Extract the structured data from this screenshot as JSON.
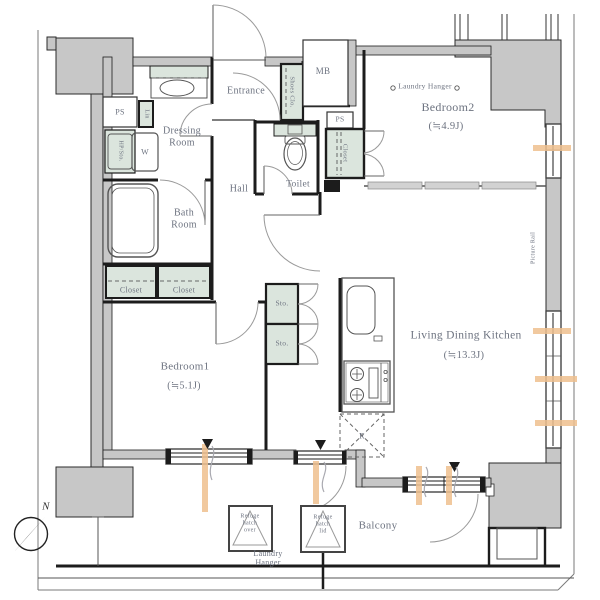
{
  "title": "apartment-floor-plan",
  "colors": {
    "wall": "#c7c7c7",
    "green": "#dbe5dd",
    "orange": "#eebf8e",
    "label": "#6d7380",
    "line": "#1c1c1c"
  },
  "labels": {
    "ps_left": "PS",
    "lin": "Lin",
    "utility": "HP/Sto.",
    "washer": "W",
    "dressing": {
      "l1": "Dressing",
      "l2": "Room"
    },
    "bath": {
      "l1": "Bath",
      "l2": "Room"
    },
    "closet_a": "Closet",
    "closet_b": "Closet",
    "bedroom1": {
      "name": "Bedroom1",
      "size": "(≒5.1J)"
    },
    "entrance": "Entrance",
    "shoes_closet": "Shoes Clo.",
    "mb": "MB",
    "ps_right": "PS",
    "toilet": "Toilet",
    "hall": "Hall",
    "closet_bedroom2": "Closet",
    "laundry_hanger_bedroom2": "Laundry Hanger",
    "bedroom2": {
      "name": "Bedroom2",
      "size": "(≒4.9J)"
    },
    "picture_rail": "Picture Rail",
    "sto_1": "Sto.",
    "sto_2": "Sto.",
    "ldk": {
      "name": "Living Dining Kitchen",
      "size": "(≒13.3J)"
    },
    "fridge": "R",
    "balcony": "Balcony",
    "laundry_hanger_balcony": {
      "l1": "Laundry",
      "l2": "Hanger"
    },
    "refuge_hatch_left": {
      "l1": "Refuge",
      "l2": "hatch",
      "l3": "over"
    },
    "refuge_hatch_right": {
      "l1": "Refuge",
      "l2": "hatch",
      "l3": "lid"
    },
    "compass_north": "N"
  }
}
